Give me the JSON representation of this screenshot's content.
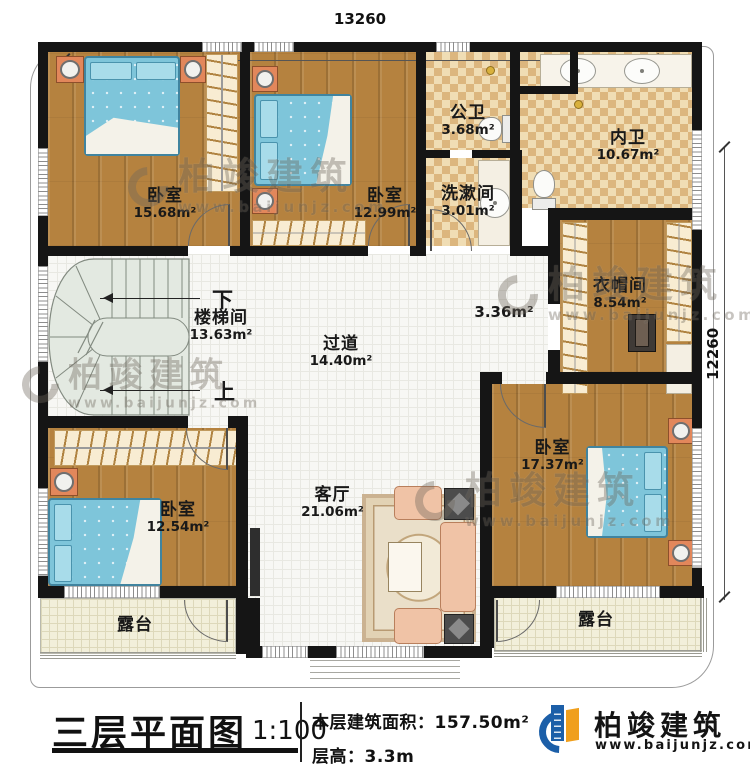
{
  "dimensions": {
    "top": "13260",
    "right": "12260"
  },
  "rooms": {
    "bedroom_top_left": {
      "name": "卧室",
      "area": "15.68m²"
    },
    "bedroom_top_mid": {
      "name": "卧室",
      "area": "12.99m²"
    },
    "public_bath": {
      "name": "公卫",
      "area": "3.68m²"
    },
    "washroom": {
      "name": "洗漱间",
      "area": "3.01m²"
    },
    "inner_bath": {
      "name": "内卫",
      "area": "10.67m²"
    },
    "cloakroom": {
      "name": "衣帽间",
      "area": "8.54m²"
    },
    "stairwell": {
      "name": "楼梯间",
      "area": "13.63m²",
      "down_label": "下",
      "up_label": "上"
    },
    "hallway": {
      "name": "过道",
      "area": "14.40m²"
    },
    "passage": {
      "area": "3.36m²"
    },
    "bedroom_bottom_left": {
      "name": "卧室",
      "area": "12.54m²"
    },
    "bedroom_bottom_right": {
      "name": "卧室",
      "area": "17.37m²"
    },
    "living_room": {
      "name": "客厅",
      "area": "21.06m²"
    },
    "terrace_left": {
      "name": "露台"
    },
    "terrace_right": {
      "name": "露台"
    }
  },
  "title_block": {
    "title": "三层平面图",
    "scale": "1:100",
    "floor_area_label": "本层建筑面积：",
    "floor_area_value": "157.50m²",
    "floor_height_label": "层高：",
    "floor_height_value": "3.3m"
  },
  "logo": {
    "name": "柏竣建筑",
    "url": "www.baijunjz.com"
  },
  "watermark": {
    "name": "柏竣建筑",
    "url": "www.baijunjz.com"
  },
  "colors": {
    "brand_blue": "#1c5fa8",
    "brand_orange": "#f09f1c",
    "wall": "#151515",
    "bed": "#7ec5da"
  }
}
